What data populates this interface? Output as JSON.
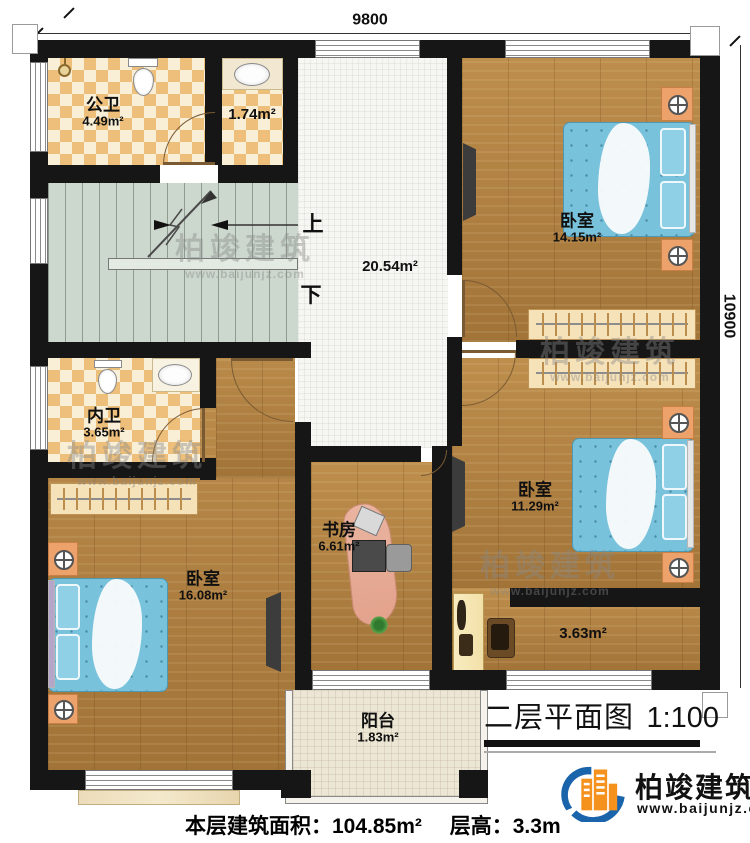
{
  "title": {
    "text": "二层平面图",
    "scale": "1:100"
  },
  "dimensions": {
    "top": "9800",
    "right": "10900"
  },
  "stairs": {
    "up": "上",
    "down": "下"
  },
  "rooms": [
    {
      "name": "公卫",
      "area": "4.49m²"
    },
    {
      "name": "",
      "area": "1.74m²"
    },
    {
      "name": "",
      "area": "20.54m²"
    },
    {
      "name": "卧室",
      "area": "14.15m²"
    },
    {
      "name": "内卫",
      "area": "3.65m²"
    },
    {
      "name": "卧室",
      "area": "11.29m²"
    },
    {
      "name": "卧室",
      "area": "16.08m²"
    },
    {
      "name": "书房",
      "area": "6.61m²"
    },
    {
      "name": "",
      "area": "3.63m²"
    },
    {
      "name": "阳台",
      "area": "1.83m²"
    }
  ],
  "footer": {
    "floor_area_label": "本层建筑面积：104.85m²",
    "height_label": "层高：3.3m"
  },
  "brand": {
    "name": "柏竣建筑",
    "url": "www.baijunjz.com"
  },
  "watermark": {
    "name": "柏竣建筑",
    "url": "www.baijunjz.com"
  },
  "colors": {
    "wall": "#161616",
    "wood": "#b28140",
    "tile_orange": "#edbf7b",
    "tile_cream": "#f9eed6",
    "stair": "#ccd7cd",
    "bed": "#79c2dc",
    "brand_blue": "#1964ab",
    "brand_orange": "#f5921e"
  },
  "icons": {
    "toilet-icon": "shape",
    "sink-icon": "oval",
    "shower-icon": "circle",
    "lamp-icon": "⊕",
    "tv-icon": "bar",
    "hanger-rod-icon": "ticks",
    "stair-direction-arrow-icon": "➤",
    "monitor-icon": "shape",
    "plant-icon": "✳",
    "brand-logo-icon": "swoosh-building"
  }
}
